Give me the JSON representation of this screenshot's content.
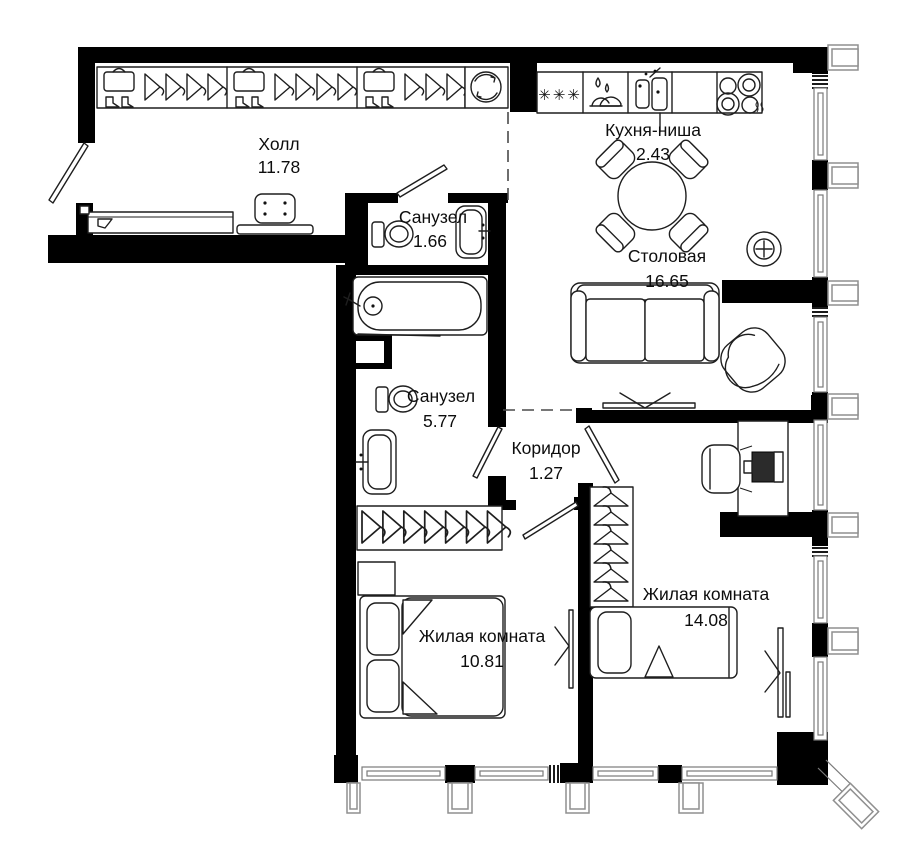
{
  "plan": {
    "rooms": [
      {
        "id": "hall",
        "name": "Холл",
        "area": "11.78"
      },
      {
        "id": "kitchen",
        "name": "Кухня-ниша",
        "area": "2.43"
      },
      {
        "id": "bath_small",
        "name": "Санузел",
        "area": "1.66"
      },
      {
        "id": "dining",
        "name": "Столовая",
        "area": "16.65"
      },
      {
        "id": "bath_big",
        "name": "Санузел",
        "area": "5.77"
      },
      {
        "id": "corridor",
        "name": "Коридор",
        "area": "1.27"
      },
      {
        "id": "bedroom1",
        "name": "Жилая комната",
        "area": "10.81"
      },
      {
        "id": "bedroom2",
        "name": "Жилая комната",
        "area": "14.08"
      }
    ],
    "icons": {
      "fridge_symbol": "✳✳✳"
    },
    "colors": {
      "wall": "#000000",
      "furniture_line": "#1e1e1e",
      "pilaster": "#8f8f8f",
      "background": "#ffffff"
    }
  }
}
